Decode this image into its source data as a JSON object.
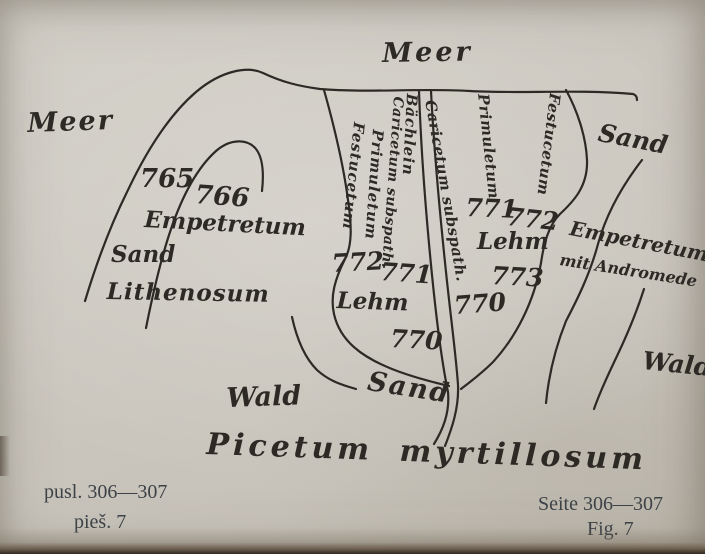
{
  "page": {
    "paper_color": "#ccc8c0",
    "ink_color": "#2d2924",
    "caption_color": "#3d4247"
  },
  "labels": {
    "meer_top": "Meer",
    "meer_left": "Meer",
    "plot_765": "765",
    "plot_766": "766",
    "empetretum_left": "Empetretum",
    "sand_left": "Sand",
    "lithenosum": "Lithenosum",
    "baechlein": "Bächlein",
    "caricetum_left": "Caricetum subspath.",
    "primuletum_left": "Primuletum",
    "festucetum_left": "Festucetum",
    "caricetum_right": "Caricetum subspath.",
    "primuletum_right": "Primuletum",
    "festucetum_right": "Festucetum",
    "plot_772_left": "772",
    "plot_771_left": "771",
    "lehm_left": "Lehm",
    "plot_770_mid": "770",
    "plot_771_right": "771",
    "plot_772_right": "772",
    "lehm_right": "Lehm",
    "plot_773": "773",
    "plot_770_right": "770",
    "sand_top_right": "Sand",
    "empetretum_right": "Empetretum",
    "mit_andromede": "mit Andromede",
    "wald_right": "Wald",
    "sand_bottom": "Sand",
    "wald_bottom": "Wald",
    "picetum": "Picetum myrtillosum"
  },
  "captions": {
    "left_line1": "pusl. 306—307",
    "left_line2": "pieš. 7",
    "right_line1": "Seite 306—307",
    "right_line2": "Fig. 7"
  }
}
